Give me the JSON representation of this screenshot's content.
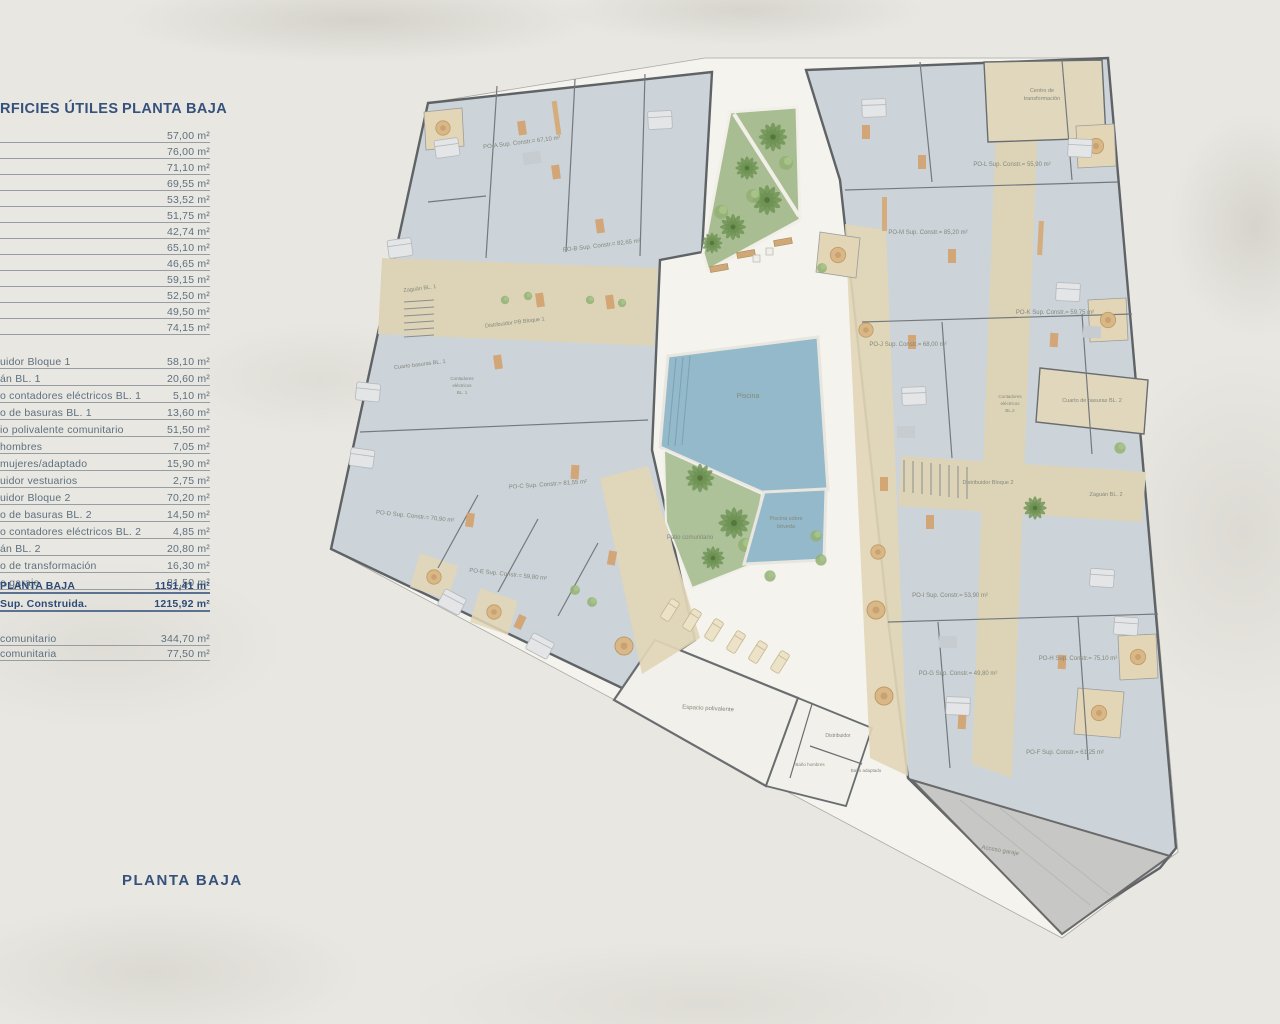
{
  "panel": {
    "header": {
      "left": "RFICIES ÚTILES",
      "right": "PLANTA BAJA"
    },
    "group1": [
      {
        "label": "",
        "value": "57,00 m²"
      },
      {
        "label": "",
        "value": "76,00 m²"
      },
      {
        "label": "",
        "value": "71,10 m²"
      },
      {
        "label": "",
        "value": "69,55 m²"
      },
      {
        "label": "",
        "value": "53,52 m²"
      },
      {
        "label": "",
        "value": "51,75 m²"
      },
      {
        "label": "",
        "value": "42,74 m²"
      },
      {
        "label": "",
        "value": "65,10 m²"
      },
      {
        "label": "",
        "value": "46,65 m²"
      },
      {
        "label": "",
        "value": "59,15 m²"
      },
      {
        "label": "",
        "value": "52,50 m²"
      },
      {
        "label": "",
        "value": "49,50 m²"
      },
      {
        "label": "",
        "value": "74,15 m²"
      }
    ],
    "group2": [
      {
        "label": "uidor Bloque 1",
        "value": "58,10 m²"
      },
      {
        "label": "án BL. 1",
        "value": "20,60 m²"
      },
      {
        "label": "o contadores eléctricos BL. 1",
        "value": "5,10 m²"
      },
      {
        "label": "o de basuras BL. 1",
        "value": "13,60 m²"
      },
      {
        "label": "io polivalente comunitario",
        "value": "51,50 m²"
      },
      {
        "label": "hombres",
        "value": "7,05 m²"
      },
      {
        "label": "mujeres/adaptado",
        "value": "15,90 m²"
      },
      {
        "label": "uidor vestuarios",
        "value": "2,75 m²"
      },
      {
        "label": "uidor Bloque 2",
        "value": "70,20 m²"
      },
      {
        "label": "o de basuras BL. 2",
        "value": "14,50 m²"
      },
      {
        "label": "o contadores eléctricos BL. 2",
        "value": "4,85 m²"
      },
      {
        "label": "án BL. 2",
        "value": "20,80 m²"
      },
      {
        "label": "o de transformación",
        "value": "16,30 m²"
      },
      {
        "label": "o garaje",
        "value": "81,50 m²"
      }
    ],
    "totals": [
      {
        "label": "PLANTA BAJA",
        "value": "1151,41 m²"
      },
      {
        "label": "Sup. Construida.",
        "value": "1215,92 m²"
      }
    ],
    "group3": [
      {
        "label": "comunitario",
        "value": "344,70 m²"
      },
      {
        "label": "comunitaria",
        "value": "77,50 m²"
      }
    ],
    "footer": "PLANTA BAJA"
  },
  "plan": {
    "labels": {
      "poA": "PO-A Sup. Constr.= 67,10 m²",
      "poB": "PO-B Sup. Constr.= 82,65 m²",
      "poC": "PO-C Sup. Constr.= 81,55 m²",
      "poD": "PO-D Sup. Constr.= 70,90 m²",
      "poE": "PO-E Sup. Constr.= 59,80 m²",
      "poF": "PO-F Sup. Constr.= 61,25 m²",
      "poG": "PO-G Sup. Constr.= 49,80 m²",
      "poH": "PO-H Sup. Constr.= 75,10 m²",
      "poI": "PO-I Sup. Constr.= 53,90 m²",
      "poJ": "PO-J Sup. Constr.= 68,00 m²",
      "poK": "PO-K Sup. Constr.= 59,75 m²",
      "poL": "PO-L Sup. Constr.= 55,90 m²",
      "poM": "PO-M Sup. Constr.= 85,20 m²",
      "zaguan1": "Zaguán BL. 1",
      "dist1": "Distribuidor PB Bloque 1",
      "basuras1": "Cuarto basuras BL. 1",
      "cont1a": "Contadores",
      "cont1b": "eléctricos",
      "cont1c": "BL. 1",
      "transf1": "Centro de",
      "transf2": "transformación",
      "basuras2": "Cuarto de basuras BL. 2",
      "cont2a": "Contadores",
      "cont2b": "eléctricos",
      "cont2c": "BL.2",
      "dist2": "Distribuidor Bloque 2",
      "zaguan2": "Zaguán BL. 2",
      "piscina": "Piscina",
      "piscina2a": "Piscina sobre",
      "piscina2b": "bóveda",
      "patio": "Patio comunitario",
      "espacio": "Espacio polivalente",
      "distribuidor": "Distribuidor",
      "banoHombres": "Baño hombres",
      "banoAdaptado": "Baño adaptado",
      "garaje": "Acceso garaje"
    },
    "colors": {
      "navy": "#35517c",
      "row_text": "#5d7080",
      "apartment_floor": "#ccd3d9",
      "corridor_beige": "#ddd4b8",
      "terrace_beige": "#e2d6b6",
      "courtyard": "#f4f3ee",
      "pool_blue": "#93b9ca",
      "garden_green": "#a9bd92",
      "garage_gray": "#c7c7c5",
      "wall_gray": "#5f6366"
    }
  }
}
